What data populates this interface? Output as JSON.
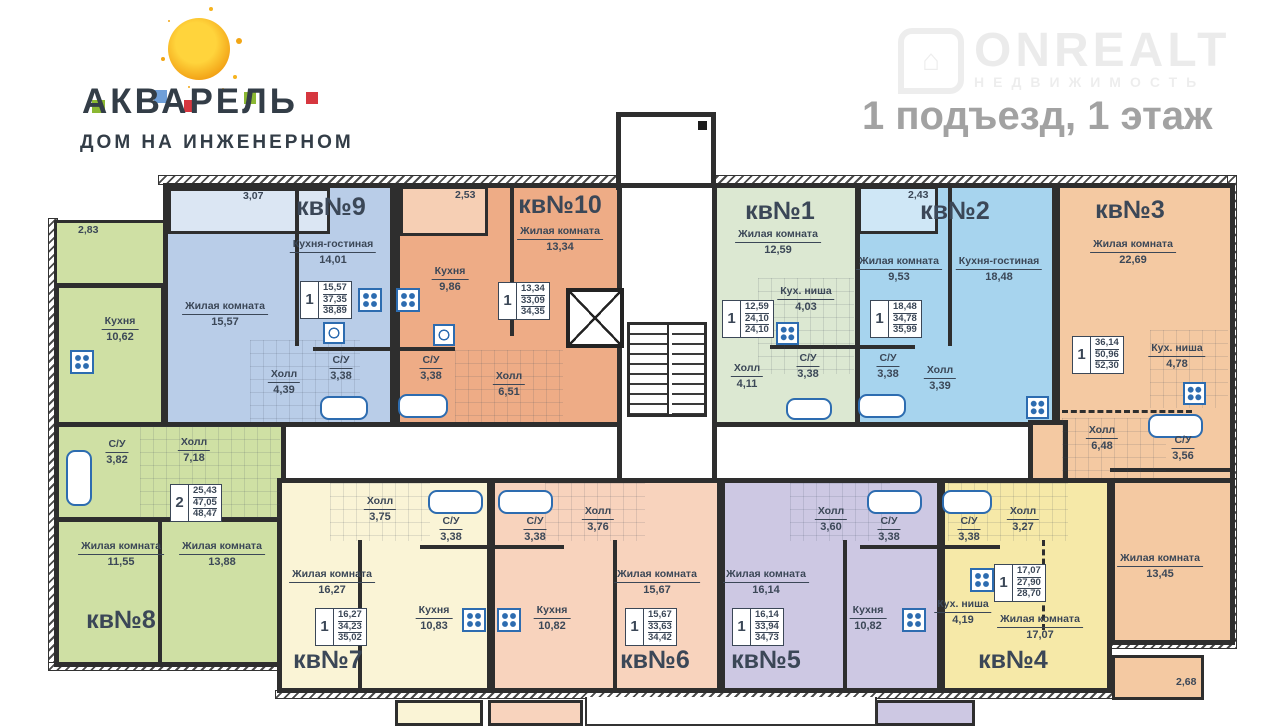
{
  "header": {
    "logo_title": "АКВАРЕЛЬ",
    "logo_subtitle": "ДОМ НА ИНЖЕНЕРНОМ",
    "page_title": "1 подъезд, 1 этаж",
    "watermark": "ONREALT",
    "watermark_sub": "НЕДВИЖИМОСТЬ",
    "logo_colors": {
      "sun": "#f2a615",
      "green": "#8bb832",
      "blue": "#6f9fd8",
      "red": "#d6373f",
      "text": "#333d47"
    }
  },
  "palette": {
    "wall": "#2e2e2e",
    "fixture_blue": "#2d6cb0",
    "label_text": "#3b4757",
    "apt_colors": {
      "apt1": "#dce8d2",
      "apt2": "#a7d4ee",
      "apt3": "#f4c9a2",
      "apt4": "#f6e9a8",
      "apt5": "#cdc8e3",
      "apt6": "#f8d3bd",
      "apt7": "#faf4d6",
      "apt8": "#cfe0a4",
      "apt9": "#b9cde8",
      "apt10": "#eeac86"
    }
  },
  "apartments": [
    {
      "title": "кв№1",
      "badge": {
        "rooms": "1",
        "live": "12,59",
        "area": "24,10",
        "total": "24,10"
      },
      "rooms": [
        {
          "name": "Жилая комната",
          "area": "12,59"
        },
        {
          "name": "Кух. ниша",
          "area": "4,03"
        },
        {
          "name": "Холл",
          "area": "4,11"
        },
        {
          "name": "С/У",
          "area": "3,38"
        }
      ]
    },
    {
      "title": "кв№2",
      "badge": {
        "rooms": "1",
        "live": "18,48",
        "area": "34,78",
        "total": "35,99"
      },
      "balcony": "2,43",
      "rooms": [
        {
          "name": "Жилая комната",
          "area": "9,53"
        },
        {
          "name": "Кухня-гостиная",
          "area": "18,48"
        },
        {
          "name": "Холл",
          "area": "3,39"
        },
        {
          "name": "С/У",
          "area": "3,38"
        }
      ]
    },
    {
      "title": "кв№3",
      "badge": {
        "rooms": "1",
        "live": "36,14",
        "area": "50,96",
        "total": "52,30"
      },
      "balcony": "2,68",
      "rooms": [
        {
          "name": "Жилая комната",
          "area": "22,69"
        },
        {
          "name": "Кух. ниша",
          "area": "4,78"
        },
        {
          "name": "Холл",
          "area": "6,48"
        },
        {
          "name": "С/У",
          "area": "3,56"
        },
        {
          "name": "Жилая комната",
          "area": "13,45"
        }
      ]
    },
    {
      "title": "кв№4",
      "badge": {
        "rooms": "1",
        "live": "17,07",
        "area": "27,90",
        "total": "28,70"
      },
      "rooms": [
        {
          "name": "Жилая комната",
          "area": "17,07"
        },
        {
          "name": "Кух. ниша",
          "area": "4,19"
        },
        {
          "name": "Холл",
          "area": "3,27"
        },
        {
          "name": "С/У",
          "area": "3,38"
        }
      ]
    },
    {
      "title": "кв№5",
      "badge": {
        "rooms": "1",
        "live": "16,14",
        "area": "33,94",
        "total": "34,73"
      },
      "rooms": [
        {
          "name": "Жилая комната",
          "area": "16,14"
        },
        {
          "name": "Кухня",
          "area": "10,82"
        },
        {
          "name": "Холл",
          "area": "3,60"
        },
        {
          "name": "С/У",
          "area": "3,38"
        }
      ]
    },
    {
      "title": "кв№6",
      "badge": {
        "rooms": "1",
        "live": "15,67",
        "area": "33,63",
        "total": "34,42"
      },
      "rooms": [
        {
          "name": "Жилая комната",
          "area": "15,67"
        },
        {
          "name": "Кухня",
          "area": "10,82"
        },
        {
          "name": "Холл",
          "area": "3,76"
        },
        {
          "name": "С/У",
          "area": "3,38"
        }
      ]
    },
    {
      "title": "кв№7",
      "badge": {
        "rooms": "1",
        "live": "16,27",
        "area": "34,23",
        "total": "35,02"
      },
      "rooms": [
        {
          "name": "Жилая комната",
          "area": "16,27"
        },
        {
          "name": "Кухня",
          "area": "10,83"
        },
        {
          "name": "Холл",
          "area": "3,75"
        },
        {
          "name": "С/У",
          "area": "3,38"
        }
      ]
    },
    {
      "title": "кв№8",
      "badge": {
        "rooms": "2",
        "live": "25,43",
        "area": "47,05",
        "total": "48,47"
      },
      "balcony": "2,83",
      "rooms": [
        {
          "name": "Жилая комната",
          "area": "11,55"
        },
        {
          "name": "Жилая комната",
          "area": "13,88"
        },
        {
          "name": "Кухня",
          "area": "10,62"
        },
        {
          "name": "Холл",
          "area": "7,18"
        },
        {
          "name": "С/У",
          "area": "3,82"
        }
      ]
    },
    {
      "title": "кв№9",
      "badge": {
        "rooms": "1",
        "live": "15,57",
        "area": "37,35",
        "total": "38,89"
      },
      "balcony": "3,07",
      "rooms": [
        {
          "name": "Жилая комната",
          "area": "15,57"
        },
        {
          "name": "Кухня-гостиная",
          "area": "14,01"
        },
        {
          "name": "Холл",
          "area": "4,39"
        },
        {
          "name": "С/У",
          "area": "3,38"
        }
      ]
    },
    {
      "title": "кв№10",
      "badge": {
        "rooms": "1",
        "live": "13,34",
        "area": "33,09",
        "total": "34,35"
      },
      "balcony": "2,53",
      "rooms": [
        {
          "name": "Жилая комната",
          "area": "13,34"
        },
        {
          "name": "Кухня",
          "area": "9,86"
        },
        {
          "name": "Холл",
          "area": "6,51"
        },
        {
          "name": "С/У",
          "area": "3,38"
        }
      ]
    }
  ]
}
